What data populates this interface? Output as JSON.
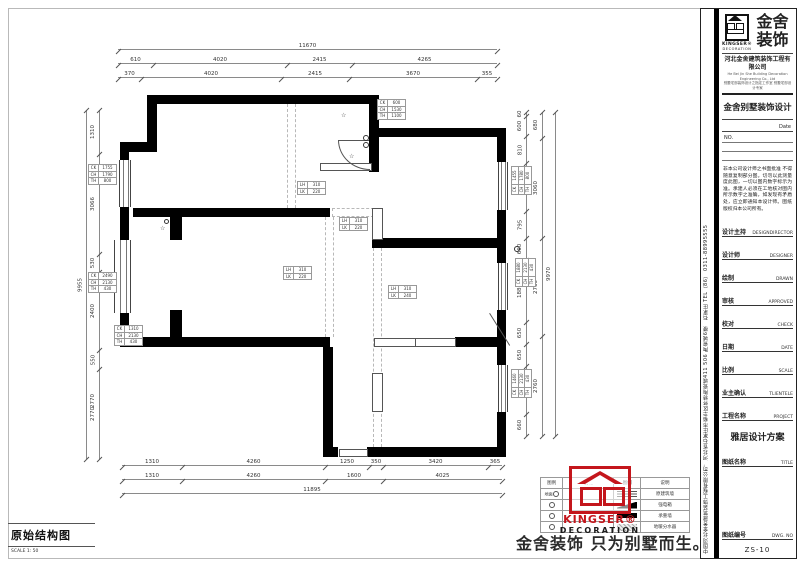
{
  "footer": {
    "drawing_title": "原始结构图",
    "scale": "SCALE 1: 50",
    "slogan": "金舍装饰 只为别墅而生。"
  },
  "stamp": {
    "en1": "KINGSER®",
    "en2": "DECORATION"
  },
  "legend": {
    "headers": [
      "图例",
      "说明",
      "图例",
      "说明"
    ],
    "rows": [
      {
        "l_text": "地面",
        "l_sym": "circle",
        "l_label": "",
        "r_sym": "hatch-h",
        "r_label": "原建筑墙"
      },
      {
        "l_text": "",
        "l_sym": "circle",
        "l_label": "",
        "r_sym": "wedge",
        "r_label": "强电箱"
      },
      {
        "l_text": "",
        "l_sym": "circle",
        "l_label": "",
        "r_sym": "solid-bar",
        "r_label": "承重墙"
      },
      {
        "l_text": "",
        "l_sym": "circle",
        "l_label": "",
        "r_sym": "hatch-d",
        "r_label": "地暖分水器"
      }
    ]
  },
  "sidebar": {
    "vertical_text": "中国河北金舍建筑装饰工程有限公司．河北省石家庄市裕华区怀特陶瓷城411 506 陶瓷城6楼　石家庄 TEL（86） 0311-88995555",
    "logo": {
      "cn1": "金舍",
      "cn2": "装饰",
      "en1": "KINGSER®",
      "en2": "DECORATION"
    },
    "company": "河北金舍建筑装饰工程有限公司",
    "company_en": "He Bei Jin She Building Decoration Engineering Co., Ltd",
    "company_sub": "别墅宅邸装饰设计之指定工作室 别墅宅邸设计专家",
    "program": "金舍别墅装饰设计",
    "date_label": "Date",
    "no_label": "NO.",
    "notice": "非本公司设计师之书面批准 不得随意复制部分图。切勿以此测量度此图，一切以图内数字标示为准。承建人必须在工地核对图内所示数字之准确，如发现有矛盾处，应立即通知本设计师。图纸版权归本公司所有。",
    "rows": [
      {
        "cn": "设计主持",
        "en": "DESIGNDIRECTOR"
      },
      {
        "cn": "设计师",
        "en": "DESIGNER"
      },
      {
        "cn": "绘制",
        "en": "DRAWN"
      },
      {
        "cn": "审核",
        "en": "APPROVED"
      },
      {
        "cn": "校对",
        "en": "CHECK"
      },
      {
        "cn": "日期",
        "en": "DATE"
      },
      {
        "cn": "比例",
        "en": "SCALE"
      },
      {
        "cn": "业主确认",
        "en": "TLIENTELE"
      },
      {
        "cn": "工程名称",
        "en": "PROJECT"
      }
    ],
    "project_name": "雅居设计方案",
    "title_row": {
      "cn": "图纸名称",
      "en": "TITLE"
    },
    "dwg_row": {
      "cn": "图纸编号",
      "en": "DWG. NO"
    },
    "dwg_no": "ZS-10"
  },
  "plan": {
    "dims_h": [
      {
        "x": 118,
        "y": 50,
        "segs": [
          [
            "11670",
            379
          ]
        ]
      },
      {
        "x": 118,
        "y": 64,
        "segs": [
          [
            "610",
            35
          ],
          [
            "4020",
            134
          ],
          [
            "2415",
            65
          ],
          [
            "4265",
            145
          ]
        ]
      },
      {
        "x": 118,
        "y": 78,
        "segs": [
          [
            "370",
            23
          ],
          [
            "4020",
            140
          ],
          [
            "2415",
            68
          ],
          [
            "3670",
            128
          ],
          [
            "355",
            20
          ]
        ]
      },
      {
        "x": 122,
        "y": 466,
        "segs": [
          [
            "1310",
            60
          ],
          [
            "4260",
            143
          ],
          [
            "1250",
            44
          ],
          [
            "350",
            14
          ],
          [
            "3420",
            105
          ],
          [
            "365",
            14
          ]
        ]
      },
      {
        "x": 122,
        "y": 480,
        "segs": [
          [
            "1310",
            60
          ],
          [
            "4260",
            143
          ],
          [
            "1600",
            58
          ],
          [
            "4025",
            119
          ]
        ]
      },
      {
        "x": 122,
        "y": 494,
        "segs": [
          [
            "11895",
            380
          ]
        ]
      }
    ],
    "dims_v": [
      {
        "x": 100,
        "y": 110,
        "segs": [
          [
            "1310",
            44
          ],
          [
            "3066",
            100
          ],
          [
            "530",
            18
          ],
          [
            "2400",
            78
          ],
          [
            "550",
            19
          ],
          [
            "2770",
            90
          ]
        ]
      },
      {
        "x": 87,
        "y": 110,
        "segs": [
          [
            "9955",
            349
          ]
        ]
      },
      {
        "x": 527,
        "y": 112,
        "segs": [
          [
            "60",
            4
          ],
          [
            "600",
            20
          ],
          [
            "810",
            27
          ],
          [
            "1455",
            48
          ],
          [
            "795",
            27
          ],
          [
            "660",
            22
          ],
          [
            "1880",
            62
          ],
          [
            "650",
            22
          ],
          [
            "650",
            22
          ],
          [
            "1460",
            48
          ],
          [
            "660",
            22
          ]
        ]
      },
      {
        "x": 543,
        "y": 112,
        "segs": [
          [
            "680",
            26
          ],
          [
            "3060",
            100
          ],
          [
            "2760",
            98
          ],
          [
            "2760",
            100
          ]
        ]
      },
      {
        "x": 556,
        "y": 112,
        "segs": [
          [
            "9970",
            324
          ]
        ]
      }
    ],
    "extra_labels": [
      {
        "x": 93,
        "y": 398,
        "t": "2770"
      }
    ],
    "tags": [
      {
        "x": 377,
        "y": 99,
        "rot": 0,
        "rows": [
          [
            "CK",
            "600"
          ],
          [
            "CH",
            "1530"
          ],
          [
            "TH",
            "1100"
          ]
        ]
      },
      {
        "x": 88,
        "y": 164,
        "rot": 0,
        "rows": [
          [
            "CK",
            "1755"
          ],
          [
            "CH",
            "1790"
          ],
          [
            "TH",
            "800"
          ]
        ]
      },
      {
        "x": 88,
        "y": 272,
        "rot": 0,
        "rows": [
          [
            "CK",
            "2490"
          ],
          [
            "CH",
            "2130"
          ],
          [
            "TH",
            "430"
          ]
        ]
      },
      {
        "x": 114,
        "y": 325,
        "rot": 0,
        "rows": [
          [
            "CK",
            "1310"
          ],
          [
            "CH",
            "2130"
          ],
          [
            "TH",
            "430"
          ]
        ]
      },
      {
        "x": 511,
        "y": 167,
        "rot": 1,
        "rows": [
          [
            "CK",
            "1455"
          ],
          [
            "CH",
            "1780"
          ],
          [
            "TH",
            "800"
          ]
        ]
      },
      {
        "x": 515,
        "y": 259,
        "rot": 1,
        "rows": [
          [
            "CK",
            "1880"
          ],
          [
            "CH",
            "2130"
          ],
          [
            "TH",
            "430"
          ]
        ]
      },
      {
        "x": 511,
        "y": 370,
        "rot": 1,
        "rows": [
          [
            "CK",
            "1460"
          ],
          [
            "CH",
            "2130"
          ],
          [
            "TH",
            "430"
          ]
        ]
      },
      {
        "x": 297,
        "y": 181,
        "rot": 0,
        "rows": [
          [
            "LH",
            "310"
          ],
          [
            "LK",
            "220"
          ]
        ]
      },
      {
        "x": 339,
        "y": 217,
        "rot": 0,
        "rows": [
          [
            "LH",
            "310"
          ],
          [
            "LK",
            "220"
          ]
        ]
      },
      {
        "x": 283,
        "y": 266,
        "rot": 0,
        "rows": [
          [
            "LH",
            "310"
          ],
          [
            "LK",
            "220"
          ]
        ]
      },
      {
        "x": 388,
        "y": 285,
        "rot": 0,
        "rows": [
          [
            "LH",
            "310"
          ],
          [
            "LK",
            "240"
          ]
        ]
      }
    ],
    "symbols": [
      {
        "x": 341,
        "y": 113,
        "t": "☆"
      },
      {
        "x": 349,
        "y": 154,
        "t": "☆"
      },
      {
        "x": 160,
        "y": 226,
        "t": "☆"
      }
    ]
  }
}
